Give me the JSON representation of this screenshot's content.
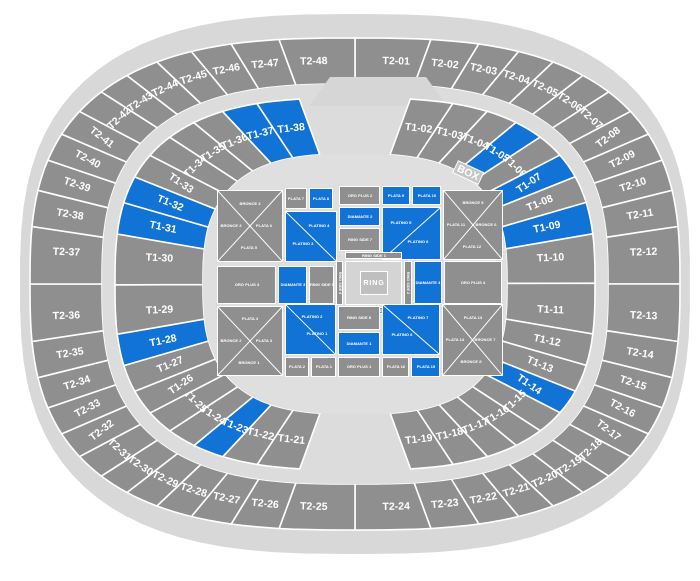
{
  "colors": {
    "highlight": "#1273d7",
    "section": "#8f8f8f",
    "rim": "#d8d8d8",
    "band": "#dcdcdc",
    "bowl": "#dfdfdf",
    "bump": "#d6d6d6",
    "ring_area": "#d4d4d4",
    "ring_box": "#bfbfbf",
    "box_tag": "#c6c6c6",
    "label": "#ffffff"
  },
  "arena": {
    "box_label": "BOX",
    "outer_sections": [
      "T2-01",
      "T2-02",
      "T2-03",
      "T2-04",
      "T2-05",
      "T2-06",
      "T2-07",
      "T2-08",
      "T2-09",
      "T2-10",
      "T2-11",
      "T2-12",
      "T2-13",
      "T2-14",
      "T2-15",
      "T2-16",
      "T2-17",
      "T2-18",
      "T2-19",
      "T2-20",
      "T2-21",
      "T2-22",
      "T2-23",
      "T2-24",
      "T2-25",
      "T2-26",
      "T2-27",
      "T2-28",
      "T2-29",
      "T2-30",
      "T2-31",
      "T2-32",
      "T2-33",
      "T2-34",
      "T2-35",
      "T2-36",
      "T2-37",
      "T2-38",
      "T2-39",
      "T2-40",
      "T2-41",
      "T2-42",
      "T2-43",
      "T2-44",
      "T2-45",
      "T2-46",
      "T2-47",
      "T2-48"
    ],
    "inner_sections": [
      {
        "label": "T1-02",
        "highlighted": false
      },
      {
        "label": "T1-03",
        "highlighted": false
      },
      {
        "label": "T1-04",
        "highlighted": false
      },
      {
        "label": "T1-05",
        "highlighted": true
      },
      {
        "label": "T1-06",
        "highlighted": false
      },
      {
        "label": "T1-07",
        "highlighted": true
      },
      {
        "label": "T1-08",
        "highlighted": false
      },
      {
        "label": "T1-09",
        "highlighted": true
      },
      {
        "label": "T1-10",
        "highlighted": false
      },
      {
        "label": "T1-11",
        "highlighted": false
      },
      {
        "label": "T1-12",
        "highlighted": false
      },
      {
        "label": "T1-13",
        "highlighted": false
      },
      {
        "label": "T1-14",
        "highlighted": true
      },
      {
        "label": "T1-15",
        "highlighted": false
      },
      {
        "label": "T1-16",
        "highlighted": false
      },
      {
        "label": "T1-17",
        "highlighted": false
      },
      {
        "label": "T1-18",
        "highlighted": false
      },
      {
        "label": "T1-19",
        "highlighted": false
      },
      {
        "label": "T1-21",
        "highlighted": false
      },
      {
        "label": "T1-22",
        "highlighted": false
      },
      {
        "label": "T1-23",
        "highlighted": true
      },
      {
        "label": "T1-24",
        "highlighted": false
      },
      {
        "label": "T1-25",
        "highlighted": false
      },
      {
        "label": "T1-26",
        "highlighted": false
      },
      {
        "label": "T1-27",
        "highlighted": false
      },
      {
        "label": "T1-28",
        "highlighted": true
      },
      {
        "label": "T1-29",
        "highlighted": false
      },
      {
        "label": "T1-30",
        "highlighted": false
      },
      {
        "label": "T1-31",
        "highlighted": true
      },
      {
        "label": "T1-32",
        "highlighted": true
      },
      {
        "label": "T1-33",
        "highlighted": false
      },
      {
        "label": "T1-34",
        "highlighted": false
      },
      {
        "label": "T1-35",
        "highlighted": false
      },
      {
        "label": "T1-36",
        "highlighted": false
      },
      {
        "label": "T1-37",
        "highlighted": true
      },
      {
        "label": "T1-38",
        "highlighted": true
      }
    ]
  },
  "floor": {
    "ring_label": "RING",
    "blocks": [
      {
        "id": "bronce-plata-nw",
        "type": "x",
        "x": 3,
        "y": 8,
        "w": 66,
        "h": 72,
        "c": "g",
        "labels": {
          "top": "BRONCE 4",
          "left": "BRONCE 3",
          "right": "PLATA 6",
          "bottom": "PLATA 5"
        }
      },
      {
        "id": "plata-7",
        "x": 71,
        "y": 6,
        "w": 22,
        "h": 21,
        "c": "g",
        "label": "PLATA 7"
      },
      {
        "id": "plata-8",
        "x": 95,
        "y": 6,
        "w": 24,
        "h": 21,
        "c": "b",
        "label": "PLATA 8"
      },
      {
        "id": "platino-3-4",
        "type": "diag",
        "x": 71,
        "y": 29,
        "w": 52,
        "h": 51,
        "c": "b",
        "dir": "tlbr",
        "a": "PLATINO 4",
        "aPos": [
          66,
          28
        ],
        "b": "PLATINO 3",
        "bPos": [
          34,
          66
        ]
      },
      {
        "id": "oro-plus-2",
        "x": 125,
        "y": 4,
        "w": 41,
        "h": 19,
        "c": "g",
        "label": "ORO PLUS 2"
      },
      {
        "id": "diamante-2",
        "x": 125,
        "y": 25,
        "w": 41,
        "h": 19,
        "c": "b",
        "label": "DIAMANTE 2"
      },
      {
        "id": "ring-side-7",
        "x": 125,
        "y": 46,
        "w": 41,
        "h": 23,
        "c": "g",
        "label": "RING SIDE 7"
      },
      {
        "id": "plata-9",
        "x": 168,
        "y": 4,
        "w": 28,
        "h": 19,
        "c": "b",
        "label": "PLATA 9"
      },
      {
        "id": "plata-10",
        "x": 198,
        "y": 4,
        "w": 29,
        "h": 19,
        "c": "b",
        "label": "PLATA 10"
      },
      {
        "id": "platino-5-6",
        "type": "diag",
        "x": 168,
        "y": 25,
        "w": 59,
        "h": 53,
        "c": "b",
        "dir": "trbl",
        "a": "PLATINO 5",
        "aPos": [
          32,
          30
        ],
        "b": "PLATINO 6",
        "bPos": [
          62,
          66
        ]
      },
      {
        "id": "bronce-plata-ne",
        "type": "x",
        "x": 229,
        "y": 8,
        "w": 60,
        "h": 70,
        "c": "g",
        "labels": {
          "top": "BRONCE 5",
          "left": "PLATA 11",
          "right": "BRONCE 6",
          "bottom": "PLATA 12"
        }
      },
      {
        "id": "oro-plus-3",
        "x": 3,
        "y": 84,
        "w": 59,
        "h": 38,
        "c": "g",
        "label": "ORO PLUS 3"
      },
      {
        "id": "diamante-3",
        "x": 64,
        "y": 84,
        "w": 29,
        "h": 38,
        "c": "b",
        "label": "DIAMANTE 3"
      },
      {
        "id": "ring-side-5",
        "x": 95,
        "y": 84,
        "w": 25,
        "h": 38,
        "c": "g",
        "label": "RING SIDE 5"
      },
      {
        "id": "ring-side-4",
        "x": 122,
        "y": 79,
        "w": 7,
        "h": 44,
        "c": "g",
        "label": "RING SIDE 4",
        "vert": true
      },
      {
        "id": "ring-side-1",
        "x": 131,
        "y": 70,
        "w": 57,
        "h": 7,
        "c": "g",
        "label": "RING SIDE 1"
      },
      {
        "id": "ring-area",
        "x": 131,
        "y": 79,
        "w": 57,
        "h": 44,
        "c": "ring_area"
      },
      {
        "id": "ring",
        "x": 146,
        "y": 89,
        "w": 28,
        "h": 24,
        "c": "ring_box",
        "label": "RING",
        "big": true
      },
      {
        "id": "ring-side-3",
        "x": 131,
        "y": 125,
        "w": 57,
        "h": 7,
        "c": "g",
        "label": "RING SIDE 3"
      },
      {
        "id": "ring-side-2",
        "x": 190,
        "y": 79,
        "w": 8,
        "h": 44,
        "c": "g",
        "label": "RING SIDE 2",
        "vert": true
      },
      {
        "id": "diamante-4",
        "x": 200,
        "y": 79,
        "w": 28,
        "h": 43,
        "c": "b",
        "label": "DIAMANTE 4"
      },
      {
        "id": "oro-plus-4",
        "x": 230,
        "y": 79,
        "w": 58,
        "h": 43,
        "c": "g",
        "label": "ORO PLUS 4"
      },
      {
        "id": "plata-bronce-sw",
        "type": "x",
        "x": 3,
        "y": 124,
        "w": 66,
        "h": 70,
        "c": "g",
        "labels": {
          "top": "PLATA 4",
          "left": "BRONCE 2",
          "right": "PLATA 3",
          "bottom": "BRONCE 1"
        }
      },
      {
        "id": "platino-1-2",
        "type": "diag",
        "x": 71,
        "y": 122,
        "w": 51,
        "h": 51,
        "c": "b",
        "dir": "tlbr",
        "a": "PLATINO 2",
        "aPos": [
          54,
          24
        ],
        "b": "PLATINO 1",
        "bPos": [
          64,
          60
        ]
      },
      {
        "id": "plata-2",
        "x": 71,
        "y": 175,
        "w": 24,
        "h": 20,
        "c": "g",
        "label": "PLATA 2"
      },
      {
        "id": "plata-1",
        "x": 97,
        "y": 175,
        "w": 25,
        "h": 20,
        "c": "g",
        "label": "PLATA 1"
      },
      {
        "id": "ring-side-8",
        "x": 124,
        "y": 124,
        "w": 42,
        "h": 24,
        "c": "g",
        "label": "RING SIDE 8"
      },
      {
        "id": "diamante-1",
        "x": 124,
        "y": 150,
        "w": 42,
        "h": 23,
        "c": "b",
        "label": "DIAMANTE 1"
      },
      {
        "id": "oro-plus-1",
        "x": 124,
        "y": 175,
        "w": 42,
        "h": 20,
        "c": "g",
        "label": "ORO PLUS 1"
      },
      {
        "id": "platino-7-8",
        "type": "diag",
        "x": 168,
        "y": 122,
        "w": 58,
        "h": 51,
        "c": "b",
        "dir": "tlbr",
        "a": "PLATINO 7",
        "aPos": [
          62,
          26
        ],
        "b": "PLATINO 8",
        "bPos": [
          34,
          62
        ]
      },
      {
        "id": "plata-16",
        "x": 168,
        "y": 175,
        "w": 27,
        "h": 20,
        "c": "g",
        "label": "PLATA 16"
      },
      {
        "id": "plata-15",
        "x": 197,
        "y": 175,
        "w": 29,
        "h": 20,
        "c": "b",
        "label": "PLATA 15"
      },
      {
        "id": "plata-bronce-se",
        "type": "x",
        "x": 228,
        "y": 122,
        "w": 61,
        "h": 72,
        "c": "g",
        "labels": {
          "top": "PLATA 13",
          "left": "PLATA 14",
          "right": "BRONCE 7",
          "bottom": "BRONCE 8"
        }
      }
    ]
  }
}
